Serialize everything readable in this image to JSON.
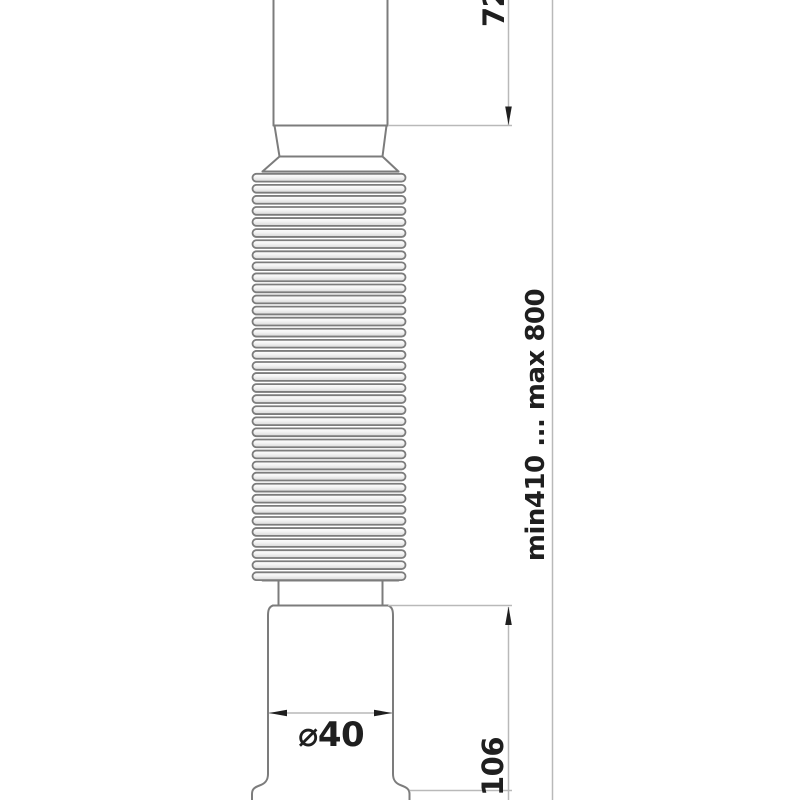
{
  "diagram": {
    "subject": "flexible corrugated drain hose with straight inlet and stepped outlet connector",
    "dimensions": {
      "inlet_length": {
        "label": "72"
      },
      "overall_length": {
        "label": "min410 ... max 800"
      },
      "outlet_diameter": {
        "label": "⌀40"
      },
      "outlet_length": {
        "label": "106"
      }
    }
  },
  "colors": {
    "part-line": "#7c7c7c",
    "dim-line": "#b9b9b9",
    "ink": "#1f1f1f",
    "bg": "#ffffff"
  }
}
